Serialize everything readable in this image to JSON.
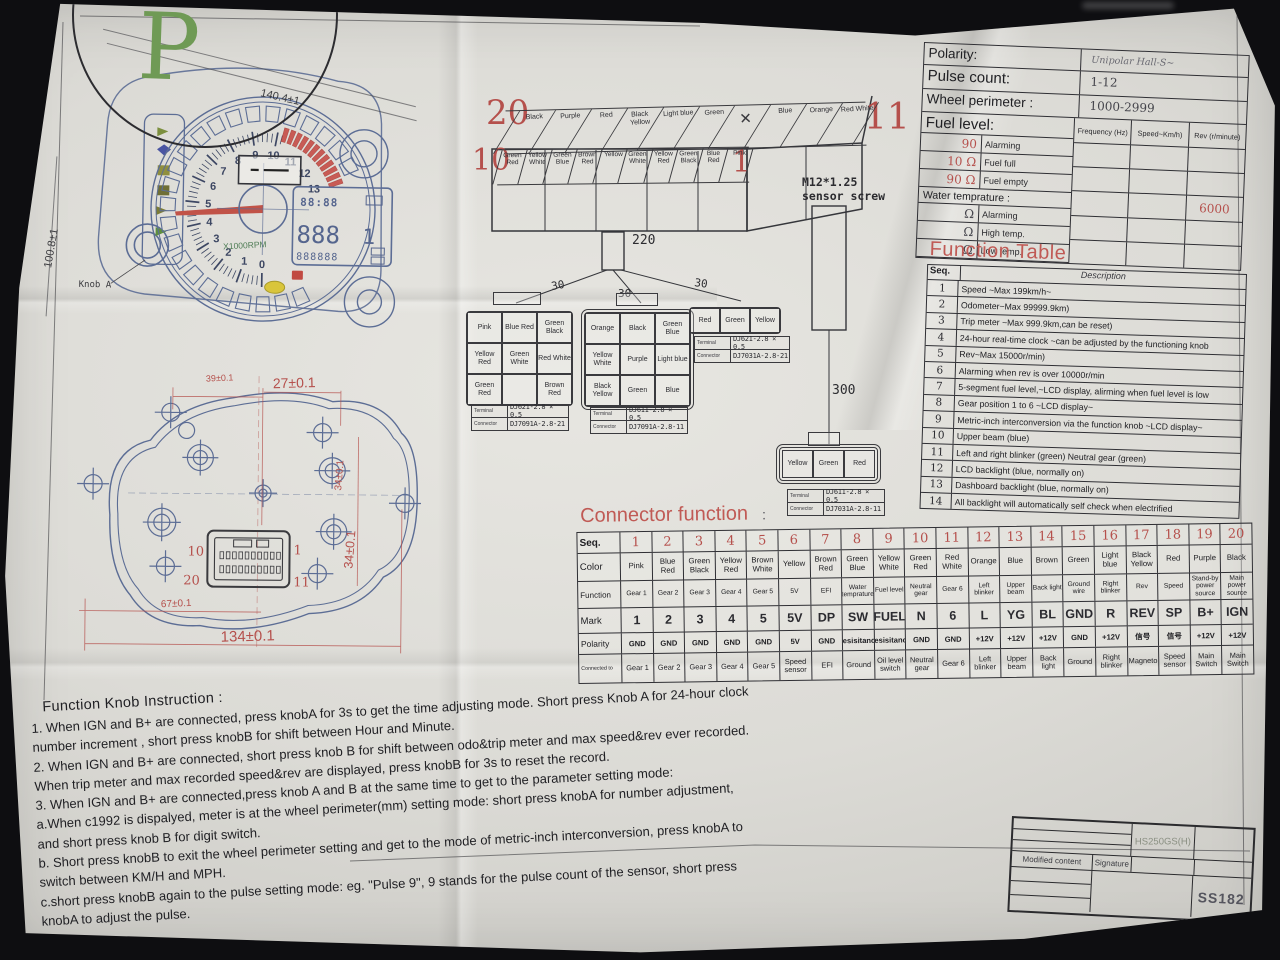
{
  "logo": {
    "letter": "P"
  },
  "background": {
    "key_label": "gUp"
  },
  "gauge": {
    "dim_width": "140.4±1",
    "dim_height": "100.8±1",
    "knob_label": "Knob A",
    "multiplier": "X1000RPM",
    "tach_numbers": [
      "0",
      "1",
      "2",
      "3",
      "4",
      "5",
      "6",
      "7",
      "8",
      "9",
      "10",
      "11",
      "12",
      "13"
    ],
    "lcd": {
      "clock": "88:88",
      "main": "888",
      "gear": "1",
      "odo": "888888"
    }
  },
  "top_connector": {
    "num_top_left": "20",
    "num_bottom_left": "10",
    "num_top_right": "11",
    "num_bottom_right": "1",
    "top_row": [
      "Black",
      "Purple",
      "Red",
      "Black Yellow",
      "Light blue",
      "Green",
      "✕",
      "Blue",
      "Orange",
      "Red White"
    ],
    "bottom_row": [
      "Green Red",
      "Yellow White",
      "Green Blue",
      "Brown Red",
      "Yellow",
      "Green White",
      "Yellow Red",
      "Green Black",
      "Blue Red",
      "Pink"
    ]
  },
  "wiring": {
    "main_label": "220",
    "branch_label": "30",
    "sensor_wire_label": "300",
    "sensor_line1": "M12*1.25",
    "sensor_line2": "sensor screw"
  },
  "part_labels": {
    "terminal": "Terminal",
    "connector": "Connector"
  },
  "blocks": [
    {
      "grid": [
        [
          "Pink",
          "Blue Red",
          "Green Black"
        ],
        [
          "Yellow Red",
          "Green White",
          "Red White"
        ],
        [
          "Green Red",
          "",
          "Brown Red"
        ]
      ],
      "terminal": "DJ621-2.8 × 0.5",
      "connector": "DJ7091A-2.8-21"
    },
    {
      "grid": [
        [
          "Orange",
          "Black",
          "Green Blue"
        ],
        [
          "Yellow White",
          "Purple",
          "Light blue"
        ],
        [
          "Black Yellow",
          "Green",
          "Blue"
        ]
      ],
      "terminal": "DJ611-2.8 × 0.5",
      "connector": "DJ7091A-2.8-11"
    },
    {
      "grid": [
        [
          "Red",
          "Green",
          "Yellow"
        ]
      ],
      "terminal": "DJ621-2.8 × 0.5",
      "connector": "DJ7031A-2.8-21"
    },
    {
      "grid": [
        [
          "Yellow",
          "Green",
          "Red"
        ]
      ],
      "terminal": "DJ611-2.8 × 0.5",
      "connector": "DJ7031A-2.8-11"
    }
  ],
  "param_table": {
    "rows": [
      {
        "label": "Polarity:",
        "value": "Unipolar Hall-S~"
      },
      {
        "label": "Pulse count:",
        "value": "1-12"
      },
      {
        "label": "Wheel perimeter :",
        "value": "1000-2999"
      }
    ],
    "fuel_header": "Fuel level:",
    "fuel_rows": [
      [
        "90",
        "Alarming"
      ],
      [
        "10 Ω",
        "Fuel full"
      ],
      [
        "90 Ω",
        "Fuel empty"
      ]
    ],
    "water_header": "Water temprature :",
    "water_rows": [
      [
        "Ω",
        "Alarming"
      ],
      [
        "Ω",
        "High temp."
      ],
      [
        "Ω",
        "Low temp."
      ]
    ],
    "freq_headers": [
      "Frequency (Hz)",
      "Speed~Km/h)",
      "Rev (r/minute)"
    ],
    "freq_grid": [
      [
        "",
        "",
        ""
      ],
      [
        "",
        "",
        ""
      ],
      [
        "",
        "",
        "6000"
      ],
      [
        "",
        "",
        ""
      ],
      [
        "",
        "",
        ""
      ]
    ]
  },
  "function_table": {
    "title": "Function Table",
    "seq_header": "Seq.",
    "desc_header": "Description",
    "rows": [
      {
        "seq": "1",
        "desc": "Speed ~Max 199km/h~"
      },
      {
        "seq": "2",
        "desc": "Odometer~Max 99999.9km)"
      },
      {
        "seq": "3",
        "desc": "Trip meter ~Max 999.9km,can be reset)"
      },
      {
        "seq": "4",
        "desc": "24-hour real-time clock ~can be adjusted by the functioning knob"
      },
      {
        "seq": "5",
        "desc": "Rev~Max 15000r/min)"
      },
      {
        "seq": "6",
        "desc": "Alarming when rev is over 10000r/min"
      },
      {
        "seq": "7",
        "desc": "5-segment fuel level,~LCD display, alirming when fuel level is low"
      },
      {
        "seq": "8",
        "desc": "Gear position 1 to 6 ~LCD display~"
      },
      {
        "seq": "9",
        "desc": "Metric-inch interconversion via the function knob ~LCD display~"
      },
      {
        "seq": "10",
        "desc": "Upper beam (blue)"
      },
      {
        "seq": "11",
        "desc": "Left and right blinker (green) Neutral gear (green)"
      },
      {
        "seq": "12",
        "desc": "LCD backlight (blue, normally on)"
      },
      {
        "seq": "13",
        "desc": "Dashboard backlight (blue, normally on)"
      },
      {
        "seq": "14",
        "desc": "All backlight will automatically self check when electrified"
      }
    ]
  },
  "connector_table": {
    "title": "Connector function",
    "colon": ":",
    "row_labels": [
      "Seq.",
      "Color",
      "Function",
      "Mark",
      "Polarity",
      "Connected to"
    ],
    "columns": [
      {
        "seq": "1",
        "color": "Pink",
        "function": "Gear 1",
        "mark": "1",
        "polarity": "GND",
        "connected_to": "Gear 1"
      },
      {
        "seq": "2",
        "color": "Blue Red",
        "function": "Gear 2",
        "mark": "2",
        "polarity": "GND",
        "connected_to": "Gear 2"
      },
      {
        "seq": "3",
        "color": "Green Black",
        "function": "Gear 3",
        "mark": "3",
        "polarity": "GND",
        "connected_to": "Gear 3"
      },
      {
        "seq": "4",
        "color": "Yellow Red",
        "function": "Gear 4",
        "mark": "4",
        "polarity": "GND",
        "connected_to": "Gear 4"
      },
      {
        "seq": "5",
        "color": "Brown White",
        "function": "Gear 5",
        "mark": "5",
        "polarity": "GND",
        "connected_to": "Gear 5"
      },
      {
        "seq": "6",
        "color": "Yellow",
        "function": "5V",
        "mark": "5V",
        "polarity": "5V",
        "connected_to": "Speed sensor"
      },
      {
        "seq": "7",
        "color": "Brown Red",
        "function": "EFI",
        "mark": "DP",
        "polarity": "GND",
        "connected_to": "EFI"
      },
      {
        "seq": "8",
        "color": "Green Blue",
        "function": "Water temprature",
        "mark": "SW",
        "polarity": "Resisitance",
        "connected_to": "Ground"
      },
      {
        "seq": "9",
        "color": "Yellow White",
        "function": "Fuel level",
        "mark": "FUEL",
        "polarity": "Resisitance",
        "connected_to": "Oil level switch"
      },
      {
        "seq": "10",
        "color": "Green Red",
        "function": "Neutral gear",
        "mark": "N",
        "polarity": "GND",
        "connected_to": "Neutral gear"
      },
      {
        "seq": "11",
        "color": "Red White",
        "function": "Gear 6",
        "mark": "6",
        "polarity": "GND",
        "connected_to": "Gear 6"
      },
      {
        "seq": "12",
        "color": "Orange",
        "function": "Left blinker",
        "mark": "L",
        "polarity": "+12V",
        "connected_to": "Left blinker"
      },
      {
        "seq": "13",
        "color": "Blue",
        "function": "Upper beam",
        "mark": "YG",
        "polarity": "+12V",
        "connected_to": "Upper beam"
      },
      {
        "seq": "14",
        "color": "Brown",
        "function": "Back light",
        "mark": "BL",
        "polarity": "+12V",
        "connected_to": "Back light"
      },
      {
        "seq": "15",
        "color": "Green",
        "function": "Ground wire",
        "mark": "GND",
        "polarity": "GND",
        "connected_to": "Ground"
      },
      {
        "seq": "16",
        "color": "Light blue",
        "function": "Right blinker",
        "mark": "R",
        "polarity": "+12V",
        "connected_to": "Right blinker"
      },
      {
        "seq": "17",
        "color": "Black Yellow",
        "function": "Rev",
        "mark": "REV",
        "polarity": "信号",
        "connected_to": "Magneto"
      },
      {
        "seq": "18",
        "color": "Red",
        "function": "Speed",
        "mark": "SP",
        "polarity": "信号",
        "connected_to": "Speed sensor"
      },
      {
        "seq": "19",
        "color": "Purple",
        "function": "Stand-by power source",
        "mark": "B+",
        "polarity": "+12V",
        "connected_to": "Main Switch"
      },
      {
        "seq": "20",
        "color": "Black",
        "function": "Main power source",
        "mark": "IGN",
        "polarity": "+12V",
        "connected_to": "Main Switch"
      }
    ]
  },
  "housing": {
    "dim_39": "39±0.1",
    "dim_27": "27±0.1",
    "dim_34a": "34±0.1",
    "dim_34b": "34±0.1",
    "dim_67": "67±0.1",
    "dim_134": "134±0.1",
    "pin_top_left": "10",
    "pin_top_right": "1",
    "pin_bottom_left": "20",
    "pin_bottom_right": "11"
  },
  "instructions": {
    "title": "Function Knob Instruction :",
    "lines": [
      "1. When IGN and B+ are connected, press knobA for 3s to get the time adjusting mode. Short press Knob A for 24-hour clock",
      "number increment , short press knobB for shift between Hour and Minute.",
      "2. When IGN and B+ are connected, short press knob B for shift between odo&trip meter and max speed&rev ever recorded.",
      "When trip meter and max recorded speed&rev are displayed, press knobB for 3s to reset the record.",
      "3. When IGN and B+ are connected,press knob A and B at the same time to get to the parameter setting mode:",
      "a.When c1992 is dispalyed, meter is at the wheel perimeter(mm) setting mode: short press knobA for number adjustment,",
      "and short press knob B for digit switch.",
      "b. Short press knobB to exit the wheel perimeter setting and get to the mode of metric-inch interconversion, press knobA to",
      "switch between KM/H and MPH.",
      "c.short press knobB again to the pulse setting mode: eg. \"Pulse 9\", 9 stands for the pulse count of the sensor, short press",
      "knobA to adjust the pulse."
    ]
  },
  "title_block": {
    "model": "HS250GS(H)",
    "modified_label": "Modified content",
    "signature_label": "Signature",
    "code": "SS182"
  }
}
